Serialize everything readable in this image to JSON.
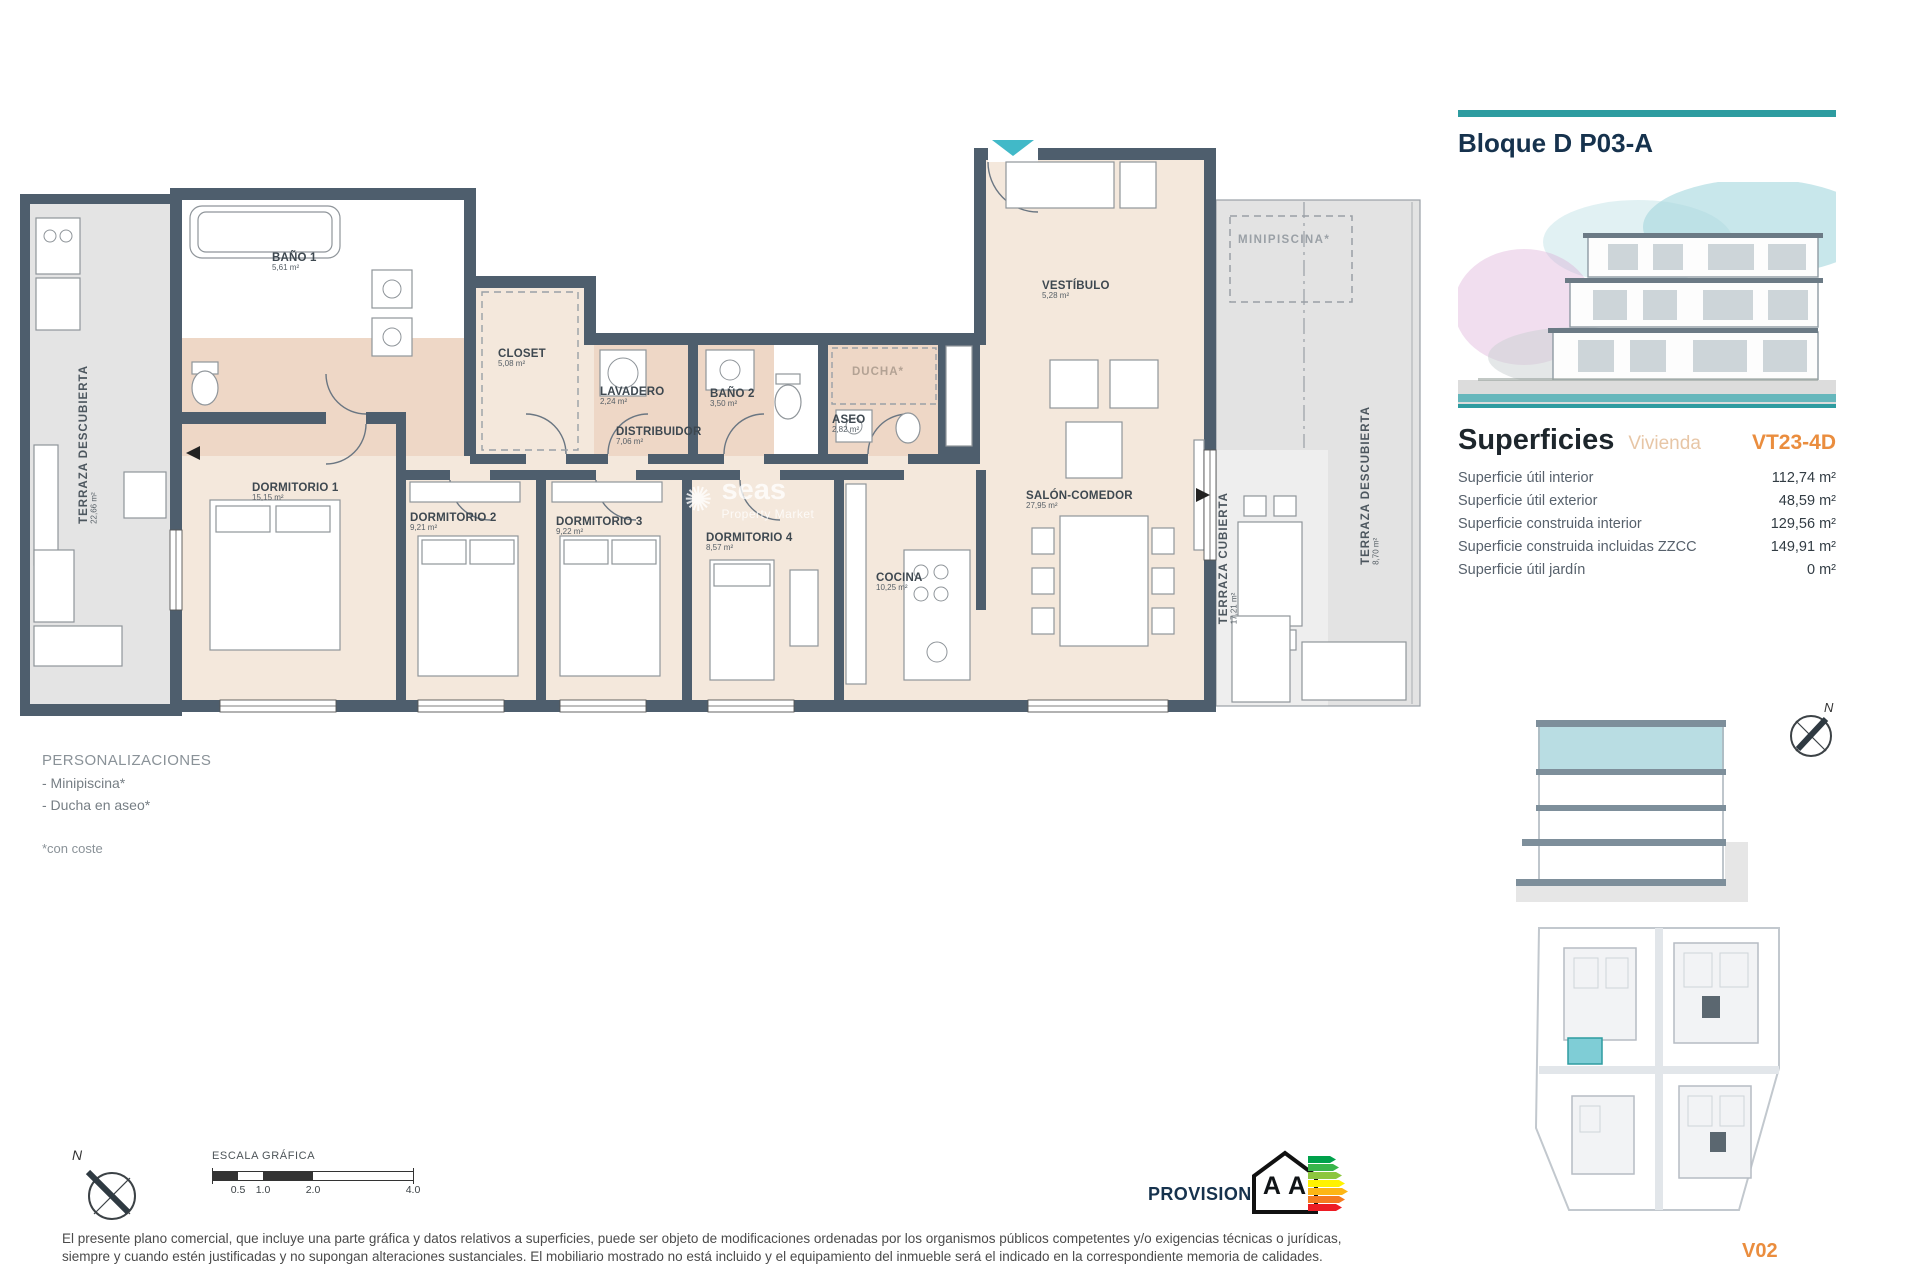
{
  "plan": {
    "rooms": [
      {
        "name": "TERRAZA DESCUBIERTA",
        "area": "22,66 m²"
      },
      {
        "name": "BAÑO 1",
        "area": "5,61 m²"
      },
      {
        "name": "CLOSET",
        "area": "5,08 m²"
      },
      {
        "name": "LAVADERO",
        "area": "2,24 m²"
      },
      {
        "name": "BAÑO 2",
        "area": "3,50 m²"
      },
      {
        "name": "ASEO",
        "area": "2,82 m²"
      },
      {
        "name": "DUCHA*",
        "area": ""
      },
      {
        "name": "VESTÍBULO",
        "area": "5,28 m²"
      },
      {
        "name": "DISTRIBUIDOR",
        "area": "7,06 m²"
      },
      {
        "name": "DORMITORIO 1",
        "area": "15,15 m²"
      },
      {
        "name": "DORMITORIO 2",
        "area": "9,21 m²"
      },
      {
        "name": "DORMITORIO 3",
        "area": "9,22 m²"
      },
      {
        "name": "DORMITORIO 4",
        "area": "8,57 m²"
      },
      {
        "name": "COCINA",
        "area": "10,25 m²"
      },
      {
        "name": "SALÓN-COMEDOR",
        "area": "27,95 m²"
      },
      {
        "name": "TERRAZA CUBIERTA",
        "area": "17,21 m²"
      },
      {
        "name": "TERRAZA DESCUBIERTA",
        "area": "8,70 m²"
      },
      {
        "name": "MINIPISCINA*",
        "area": ""
      }
    ],
    "watermark": {
      "fragment": "seas",
      "tagline": "Property Market"
    }
  },
  "personalizations": {
    "title": "PERSONALIZACIONES",
    "items": [
      "- Minipiscina*",
      "- Ducha en aseo*"
    ],
    "note": "*con coste"
  },
  "scale_bar": {
    "title": "ESCALA GRÁFICA",
    "labels": [
      "0.5",
      "1.0",
      "2.0",
      "4.0"
    ]
  },
  "compass": {
    "north": "N"
  },
  "energy": {
    "provisional": "PROVISIONAL",
    "letters": "A A"
  },
  "disclaimer": "El presente plano comercial, que incluye una parte gráfica y datos relativos a superficies, puede ser objeto de modificaciones ordenadas por los organismos públicos competentes y/o exigencias técnicas o jurídicas, siempre y cuando estén justificadas y no supongan alteraciones sustanciales. El mobiliario mostrado no está incluido y el equipamiento del inmueble será el indicado en la correspondiente memoria de calidades.",
  "panel": {
    "title": "Bloque D P03-A",
    "superficies_title": "Superficies",
    "superficies_subtitle": "Vivienda",
    "unit_code": "VT23-4D",
    "rows": [
      {
        "label": "Superficie útil interior",
        "value": "112,74 m²"
      },
      {
        "label": "Superficie útil exterior",
        "value": "48,59 m²"
      },
      {
        "label": "Superficie construida interior",
        "value": "129,56 m²"
      },
      {
        "label": "Superficie construida incluidas ZZCC",
        "value": "149,91 m²"
      },
      {
        "label": "Superficie útil jardín",
        "value": "0 m²"
      }
    ],
    "version": "V02"
  },
  "colors": {
    "accent_teal": "#2e9ca0",
    "accent_orange": "#ea8d3e",
    "navy": "#16324d",
    "wall": "#4e5e6d",
    "floor_beige": "#f4e8dc",
    "wet_room_pink": "#eed7c6",
    "terrace_grey": "#e3e3e3",
    "section_highlight": "#b9dde3",
    "entrance_marker": "#41b9c8"
  }
}
